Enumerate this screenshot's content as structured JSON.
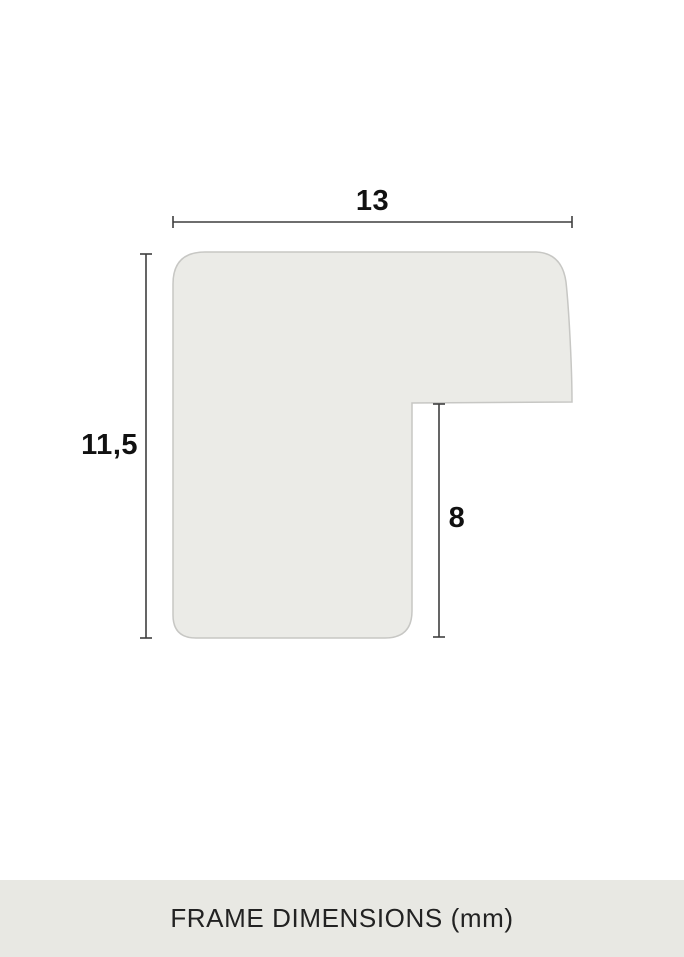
{
  "diagram": {
    "type": "frame-profile-cross-section",
    "dimensions": {
      "width": {
        "label": "13",
        "value": 13,
        "unit": "mm"
      },
      "height": {
        "label": "11,5",
        "value": 11.5,
        "unit": "mm"
      },
      "rabbet": {
        "label": "8",
        "value": 8,
        "unit": "mm"
      }
    },
    "colors": {
      "background": "#ffffff",
      "profile_fill": "#ebebe7",
      "profile_stroke": "#c7c7c4",
      "dimension_line": "#3f3f3f",
      "label_text": "#111111",
      "footer_bg": "#e8e8e3",
      "footer_text": "#222222"
    }
  },
  "footer": {
    "caption": "FRAME DIMENSIONS (mm)"
  }
}
